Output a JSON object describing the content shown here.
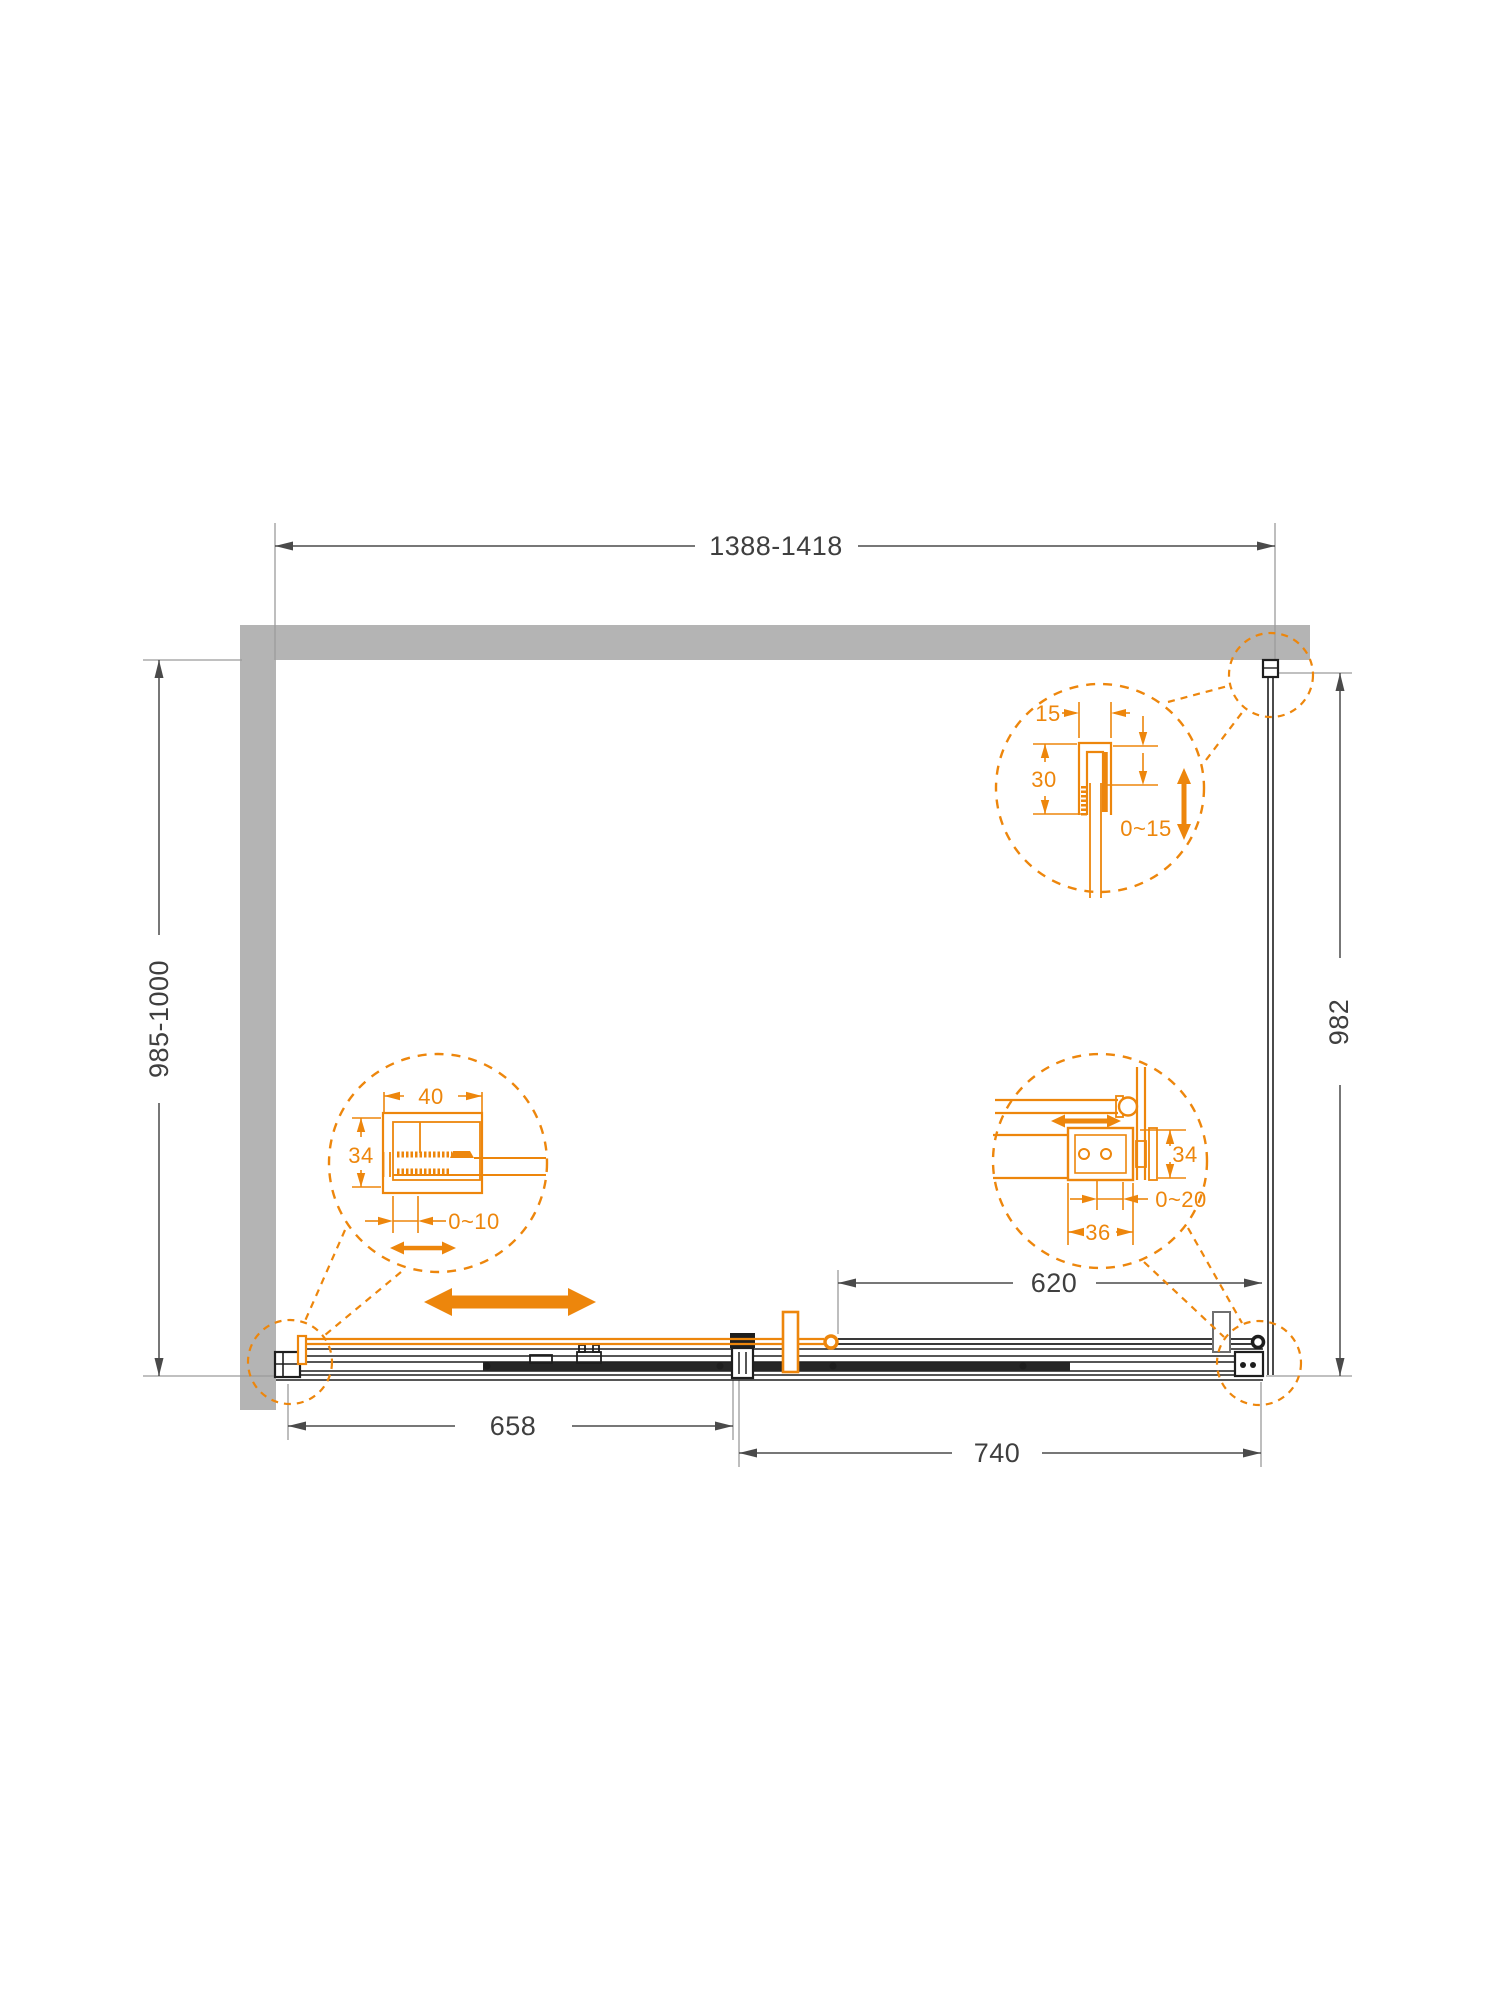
{
  "drawing": {
    "type": "shower-enclosure-plan-technical-drawing",
    "overall": {
      "width_range": "1388-1418",
      "left_depth_range": "985-1000",
      "side_panel_depth": "982",
      "fixed_segment": "658",
      "door_segment": "740",
      "opening_width": "620"
    },
    "detail_wall_profile": {
      "profile_width": "15",
      "profile_depth": "30",
      "adjustment": "0~15"
    },
    "detail_door_profile": {
      "profile_width": "40",
      "profile_depth": "34",
      "adjustment": "0~10"
    },
    "detail_panel_connector": {
      "bracket_depth": "34",
      "adjustment": "0~20",
      "bracket_width": "36"
    },
    "colors": {
      "accent_orange": "#ED860C",
      "wall_gray": "#B4B4B4",
      "line_dark": "#1E1E1E",
      "dim_gray": "#4A4A4A"
    }
  }
}
